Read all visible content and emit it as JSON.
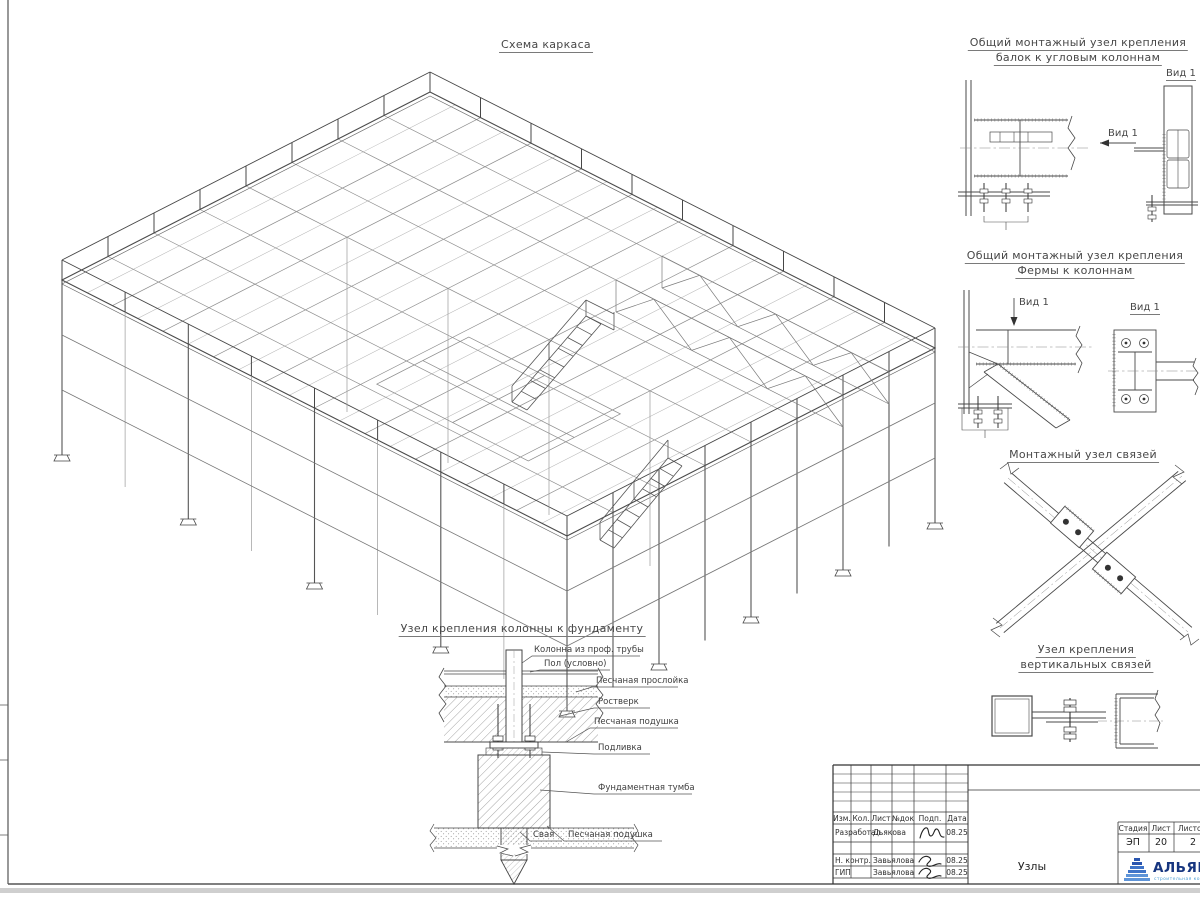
{
  "main_view": {
    "title": "Схема каркаса"
  },
  "details": {
    "corner_beams": {
      "title1": "Общий монтажный узел крепления",
      "title2": "балок к угловым колоннам",
      "view_title": "Вид 1",
      "arrow_label": "Вид 1"
    },
    "truss_to_column": {
      "title1": "Общий монтажный узел крепления",
      "title2": "Фермы к колоннам",
      "view_title": "Вид 1",
      "arrow_label": "Вид 1"
    },
    "braces_node": {
      "title": "Монтажный узел связей"
    },
    "vertical_braces": {
      "title1": "Узел крепления",
      "title2": "вертикальных связей"
    },
    "foundation": {
      "title": "Узел крепления колонны к фундаменту",
      "labels": {
        "column": "Колонна из проф. трубы",
        "floor": "Пол (условно)",
        "sand_layer": "Песчаная прослойка",
        "grillage": "Ростверк",
        "sand_pad_upper": "Песчаная подушка",
        "grout": "Подливка",
        "pedestal": "Фундаментная тумба",
        "pile": "Свая",
        "sand_pad_lower": "Песчаная подушка"
      }
    }
  },
  "title_block": {
    "columns": [
      "Изм.",
      "Кол.",
      "Лист",
      "№док",
      "Подп.",
      "Дата"
    ],
    "rows": [
      {
        "role": "Разработал",
        "name": "Дьякова",
        "date": "08.25"
      },
      {
        "role": "Н. контр.",
        "name": "Завьялова",
        "date": "08.25"
      },
      {
        "role": "ГИП",
        "name": "Завьялова",
        "date": "08.25"
      }
    ],
    "stage_label": "Стадия",
    "stage": "ЭП",
    "sheet_label": "Лист",
    "sheet": "20",
    "sheets_label": "Листов",
    "sheets": "2",
    "doc_name": "Узлы",
    "logo": {
      "text": "АЛЬЯНС",
      "subtext": "строительная компания",
      "color": "#16357f",
      "light": "#4d9fd6"
    }
  }
}
